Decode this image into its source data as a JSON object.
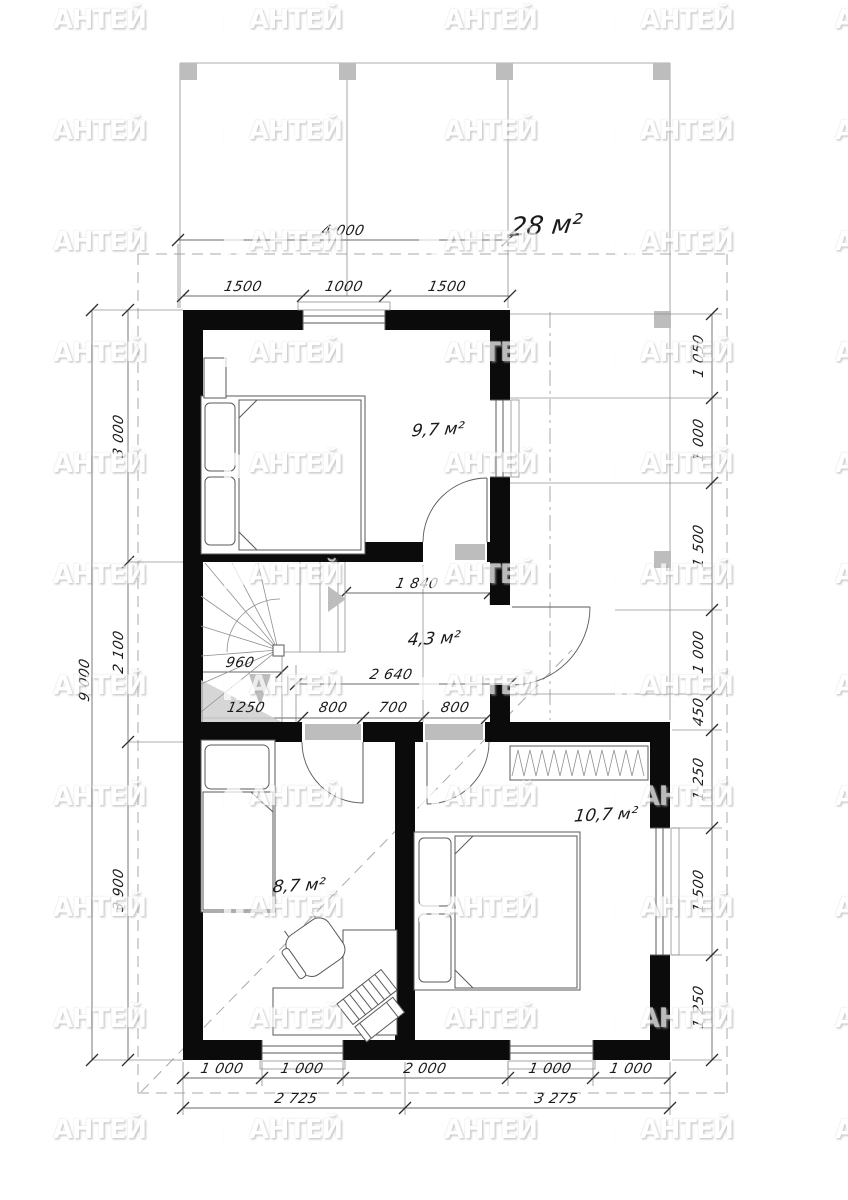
{
  "watermark": {
    "brand": "АНТЕЙ"
  },
  "annotations": {
    "total_area": "28 м²",
    "rooms": {
      "bedroom_top": "9,7 м²",
      "hall": "4,3 м²",
      "bedroom_left": "8,7 м²",
      "bedroom_right": "10,7 м²"
    }
  },
  "dimensions": {
    "top_overall": "4 000",
    "top_chain": [
      "1500",
      "1000",
      "1500"
    ],
    "left_overall": "9 000",
    "left_chain": [
      "3 000",
      "2 100",
      "3 900"
    ],
    "right_upper_chain": [
      "1 050",
      "1 000",
      "1 500",
      "1 000",
      "450"
    ],
    "right_lower_chain": [
      "1 250",
      "1 500",
      "1 250"
    ],
    "bottom_chain": [
      "1 000",
      "1 000",
      "2 000",
      "1 000",
      "1 000"
    ],
    "bottom_overall": [
      "2 725",
      "3 275"
    ],
    "hall": {
      "width_upper": "1 840",
      "width_full": "2 640",
      "stair_width": "960",
      "bottom_chain": [
        "1250",
        "800",
        "700",
        "800"
      ]
    }
  }
}
